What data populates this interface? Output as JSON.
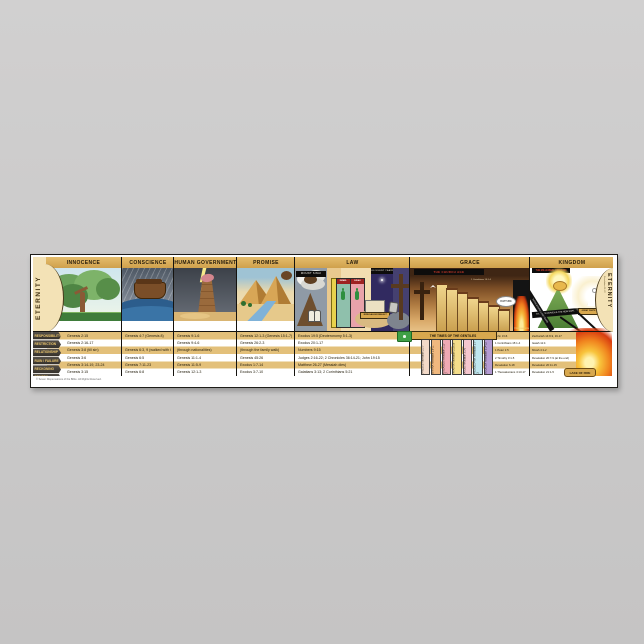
{
  "wall": {
    "color": "#cbcaca"
  },
  "poster": {
    "accent_gold": "#d8a84e",
    "sections": [
      "INNOCENCE",
      "CONSCIENCE",
      "HUMAN GOVERNMENT",
      "PROMISE",
      "LAW",
      "GRACE",
      "KINGDOM"
    ],
    "eternity_left": "ETERNITY",
    "eternity_right": "ETERNITY",
    "eternity_right_note": "Revelation 21-22",
    "row_labels": [
      "RESPONSIBILITY",
      "RESTRICTION",
      "RELATIONSHIP",
      "RUIN / FAILURE",
      "RECKONING",
      "REMEDY"
    ],
    "columns": {
      "innocence": {
        "refs": [
          "Genesis 2:15",
          "Genesis 2:16-17",
          "Genesis 3:8 (till sin)",
          "Genesis 3:6",
          "Genesis 3:14-19, 23-24",
          "Genesis 3:15"
        ]
      },
      "conscience": {
        "refs": [
          "Genesis 4:7 (Genesis 8)",
          "",
          "Genesis 6:3, 9 (walked with God)",
          "Genesis 6:5",
          "Genesis 7:11-23",
          "Genesis 6:8"
        ]
      },
      "human_government": {
        "refs": [
          "Genesis 9:1-6",
          "Genesis 9:4-6",
          "(through nationalities)",
          "Genesis 11:1-4",
          "Genesis 11:5-9",
          "Genesis 12:1-3"
        ]
      },
      "promise": {
        "refs": [
          "Genesis 12:1-3 (Genesis 15:1-7)",
          "Genesis 26:2-3",
          "(through the family walk)",
          "Genesis 45:26",
          "Exodus 1:7-14",
          "Exodus 3:7-10"
        ]
      },
      "law": {
        "refs": [
          "Exodus 19:5 (Deuteronomy 5:1-3)",
          "Exodus 20:1-17",
          "Numbers 9:15",
          "Judges 2:16-22; 2 Chronicles 36:14-21; John 19:15",
          "Matthew 26-27 (Messiah dies)",
          "Galatians 3:13; 2 Corinthians 5:21"
        ]
      },
      "grace": {
        "refs": [
          "John 3:16",
          "1 Corinthians 15:1-4",
          "1 Peter 1:5",
          "2 Timothy 3:1-5",
          "Revelation 6-18",
          "1 Thessalonians 4:13-17"
        ]
      },
      "kingdom": {
        "refs": [
          "Zechariah 14:8-9, 16-17",
          "Isaiah 11:4",
          "Micah 4:1-2",
          "Revelation 20:7-9 (at the end)",
          "Revelation 20:11-15",
          "Revelation 21:1-5"
        ]
      }
    },
    "law": {
      "sinai_banner": "MOUNT SINAI",
      "israel_label": "ISRAEL",
      "judah_label": "JUDAH",
      "jerusalem_banner": "JERUSALEM REBUILT",
      "silent_years": "400 SILENT YEARS"
    },
    "grace": {
      "church_banner": "THE CHURCH AGE",
      "note": "1 Corinthians 15:1-4",
      "rapture": "RAPTURE",
      "tribulation": "TRIBULATION",
      "gentiles_banner": "THE TIMES OF THE GENTILES",
      "churches": [
        {
          "name": "EPHESUS",
          "ref": "Revelation 2:1-7",
          "color": "#f2d9c8"
        },
        {
          "name": "SMYRNA",
          "ref": "Revelation 2:8-11",
          "color": "#f0b87e"
        },
        {
          "name": "PERGAMOS",
          "ref": "Revelation 2:12-17",
          "color": "#efa9b4"
        },
        {
          "name": "THYATIRA",
          "ref": "Revelation 2:18-29",
          "color": "#f3dd8a"
        },
        {
          "name": "SARDIS",
          "ref": "Revelation 3:1-6",
          "color": "#f5c6ce"
        },
        {
          "name": "PHILADELPHIA",
          "ref": "Revelation 3:7-13",
          "color": "#bfe6ef"
        },
        {
          "name": "LAODICEA",
          "ref": "Revelation 3:14-22",
          "color": "#b49bd3"
        }
      ]
    },
    "kingdom": {
      "top_banner": "THE MILLENNIAL KINGDOM",
      "new_earth_banner": "THE NEW HEAVEN & THE NEW EARTH",
      "throne_label": "GREAT WHITE THRONE",
      "satan_ribbon": "SATAN BOUND 1,000 YEARS",
      "lake_label": "LAKE OF FIRE"
    },
    "copyright": "© Seven Dispensations of the Bible. All Rights Reserved."
  }
}
